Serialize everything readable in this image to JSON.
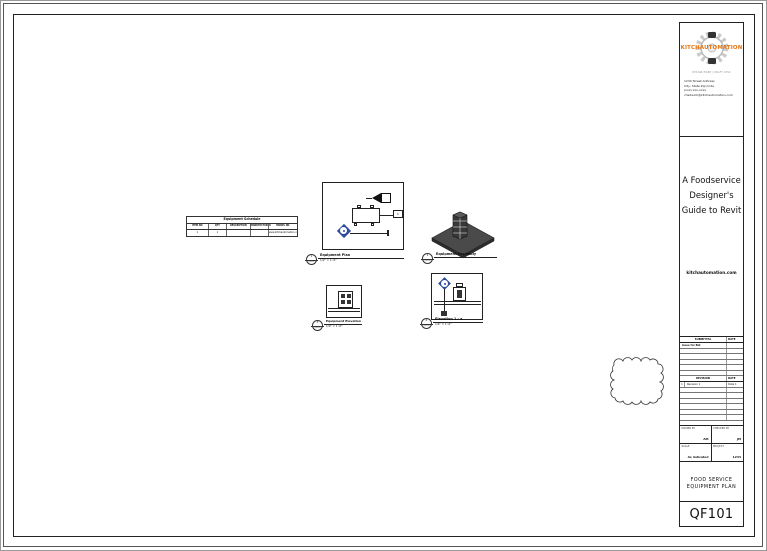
{
  "colors": {
    "accent_orange": "#e8720c",
    "marker_blue": "#2d4a9e",
    "slab_gray": "#4a4a4a"
  },
  "titleblock": {
    "brand": "KITCHAUTOMATION",
    "tagline": "DESIGN MORE | DRAFT LESS",
    "address_lines": [
      "1234 Street Address",
      "City, State Zip Code",
      "(xxx) xxx-xxxx",
      "chadwick@kitchautomation.com"
    ],
    "project_title_lines": [
      "A Foodservice",
      "Designer's",
      "Guide to Revit"
    ],
    "website": "kitchautomation.com",
    "submittal": {
      "col1": "SUBMITTAL",
      "col2": "DATE",
      "rows": [
        {
          "name": "Issue for Bid",
          "date": ""
        }
      ]
    },
    "revision": {
      "col1": "REVISION",
      "col2": "DATE",
      "rows": [
        {
          "num": "1",
          "name": "Revision 1",
          "date": "Date 1"
        }
      ]
    },
    "fields": {
      "drawn_by_label": "DRAWN BY",
      "drawn_by_value": "AM",
      "checked_by_label": "CHECKED BY",
      "checked_by_value": "JM",
      "scale_label": "SCALE",
      "scale_value": "As indicated",
      "project_label": "PROJECT",
      "project_value": "1234"
    },
    "sheet_name_line1": "FOOD SERVICE",
    "sheet_name_line2": "EQUIPMENT PLAN",
    "sheet_number": "QF101"
  },
  "schedule_table": {
    "title": "Equipment Schedule",
    "headers": [
      "ITEM NO",
      "QTY",
      "DESCRIPTION",
      "MANUFACTURER",
      "MODEL NO"
    ],
    "row": [
      "1",
      "1",
      "",
      "",
      "www.kitchautomation.com"
    ]
  },
  "views": [
    {
      "number": "1",
      "sheet_ref": "QF101",
      "name": "Equipment Plan",
      "scale": "1/2\" = 1'-0\""
    },
    {
      "number": "2",
      "sheet_ref": "QF101",
      "name": "Equipment Assembly",
      "scale": ""
    },
    {
      "number": "3",
      "sheet_ref": "QF101",
      "name": "Equipment Elevation",
      "scale": "1/2\" = 1'-0\""
    },
    {
      "number": "4",
      "sheet_ref": "QF101",
      "name": "Elevation 1 - a",
      "scale": "1/4\" = 1'-0\""
    }
  ],
  "plan_view": {
    "tag_text": "1"
  }
}
